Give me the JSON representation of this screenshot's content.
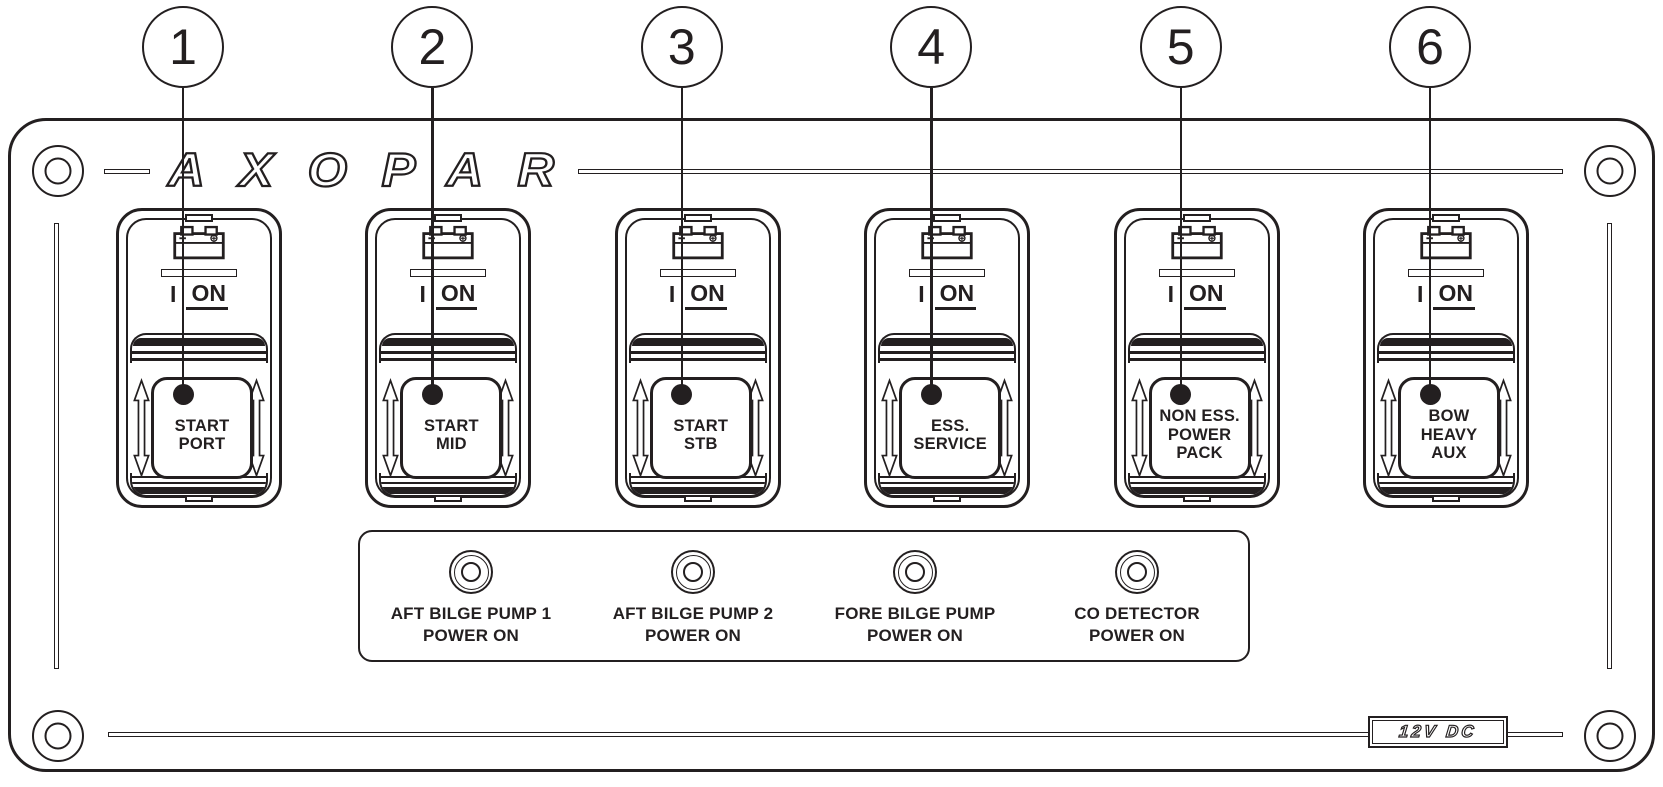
{
  "panel": {
    "brand_logo": "AXOPAR",
    "voltage_badge": "12V DC"
  },
  "callouts": [
    "1",
    "2",
    "3",
    "4",
    "5",
    "6"
  ],
  "switches": [
    {
      "callout": "1",
      "icon": "battery-icon",
      "position_indicator": "I",
      "on_label": "ON",
      "label": "START\nPORT"
    },
    {
      "callout": "2",
      "icon": "battery-icon",
      "position_indicator": "I",
      "on_label": "ON",
      "label": "START\nMID"
    },
    {
      "callout": "3",
      "icon": "battery-icon",
      "position_indicator": "I",
      "on_label": "ON",
      "label": "START\nSTB"
    },
    {
      "callout": "4",
      "icon": "battery-icon",
      "position_indicator": "I",
      "on_label": "ON",
      "label": "ESS.\nSERVICE"
    },
    {
      "callout": "5",
      "icon": "battery-icon",
      "position_indicator": "I",
      "on_label": "ON",
      "label": "NON ESS.\nPOWER\nPACK"
    },
    {
      "callout": "6",
      "icon": "battery-icon",
      "position_indicator": "I",
      "on_label": "ON",
      "label": "BOW\nHEAVY\nAUX"
    }
  ],
  "indicator_lights": [
    {
      "label": "AFT BILGE PUMP 1\nPOWER ON"
    },
    {
      "label": "AFT BILGE PUMP 2\nPOWER ON"
    },
    {
      "label": "FORE BILGE PUMP\nPOWER ON"
    },
    {
      "label": "CO DETECTOR\nPOWER ON"
    }
  ],
  "colors": {
    "line": "#231f20",
    "background": "#ffffff"
  }
}
